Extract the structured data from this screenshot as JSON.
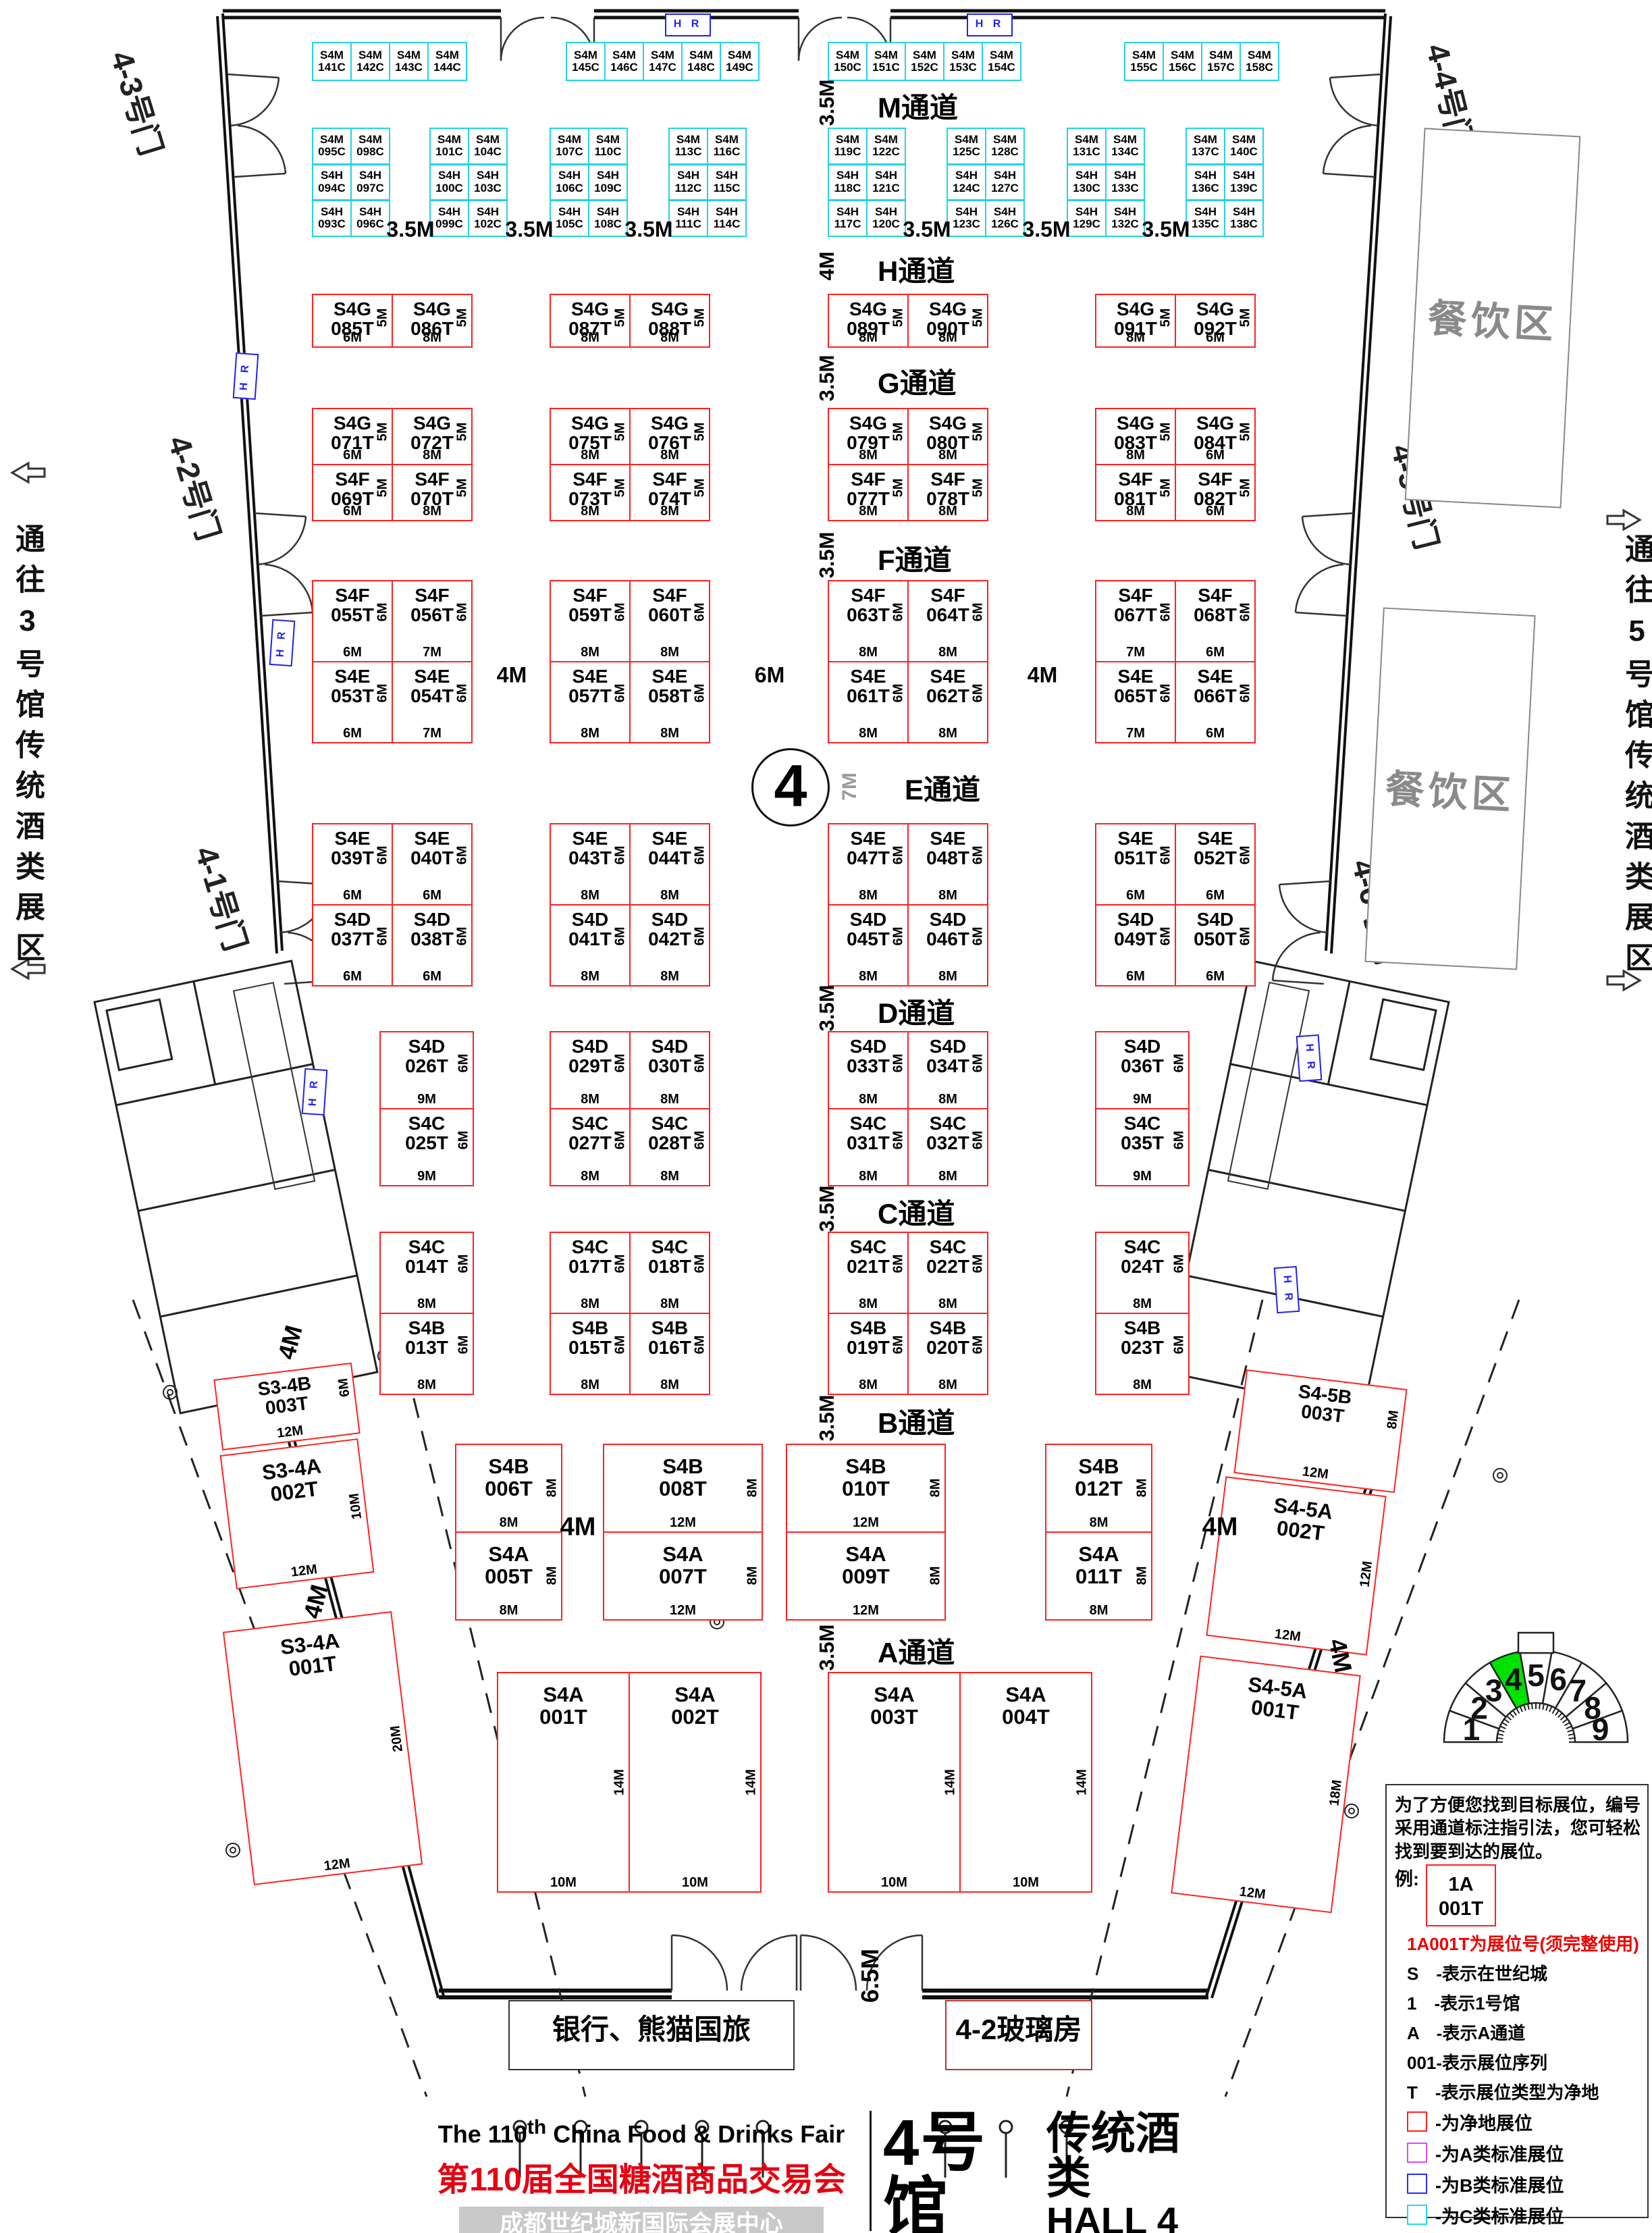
{
  "hall_circle": "4",
  "aisles": [
    {
      "dim": "3.5M",
      "name": "M通道"
    },
    {
      "dim": "4M",
      "name": "H通道"
    },
    {
      "dim": "3.5M",
      "name": "G通道"
    },
    {
      "dim": "3.5M",
      "name": "F通道"
    },
    {
      "dim": "7M",
      "name": "E通道"
    },
    {
      "dim": "3.5M",
      "name": "D通道"
    },
    {
      "dim": "3.5M",
      "name": "C通道"
    },
    {
      "dim": "3.5M",
      "name": "B通道"
    },
    {
      "dim": "3.5M",
      "name": "A通道"
    }
  ],
  "bottom_aisle_dim": "6.5M",
  "row2_gap_dim": "3.5M",
  "fe_gap_dims": [
    "4M",
    "6M",
    "4M"
  ],
  "ba_gap_dims": [
    "4M",
    "4M"
  ],
  "corner_gap_dims": [
    "4M",
    "4M",
    "4M"
  ],
  "top_c_groups": [
    [
      "S4M|141C",
      "S4M|142C",
      "S4M|143C",
      "S4M|144C"
    ],
    [
      "S4M|145C",
      "S4M|146C",
      "S4M|147C",
      "S4M|148C",
      "S4M|149C"
    ],
    [
      "S4M|150C",
      "S4M|151C",
      "S4M|152C",
      "S4M|153C",
      "S4M|154C"
    ],
    [
      "S4M|155C",
      "S4M|156C",
      "S4M|157C",
      "S4M|158C"
    ]
  ],
  "row2_groups": [
    [
      [
        "S4M|095C",
        "S4H|094C",
        "S4H|093C"
      ],
      [
        "S4M|098C",
        "S4H|097C",
        "S4H|096C"
      ]
    ],
    [
      [
        "S4M|101C",
        "S4H|100C",
        "S4H|099C"
      ],
      [
        "S4M|104C",
        "S4H|103C",
        "S4H|102C"
      ]
    ],
    [
      [
        "S4M|107C",
        "S4H|106C",
        "S4H|105C"
      ],
      [
        "S4M|110C",
        "S4H|109C",
        "S4H|108C"
      ]
    ],
    [
      [
        "S4M|113C",
        "S4H|112C",
        "S4H|111C"
      ],
      [
        "S4M|116C",
        "S4H|115C",
        "S4H|114C"
      ]
    ],
    [
      [
        "S4M|119C",
        "S4H|118C",
        "S4H|117C"
      ],
      [
        "S4M|122C",
        "S4H|121C",
        "S4H|120C"
      ]
    ],
    [
      [
        "S4M|125C",
        "S4H|124C",
        "S4H|123C"
      ],
      [
        "S4M|128C",
        "S4H|127C",
        "S4H|126C"
      ]
    ],
    [
      [
        "S4M|131C",
        "S4H|130C",
        "S4H|129C"
      ],
      [
        "S4M|134C",
        "S4H|133C",
        "S4H|132C"
      ]
    ],
    [
      [
        "S4M|137C",
        "S4H|136C",
        "S4H|135C"
      ],
      [
        "S4M|140C",
        "S4H|139C",
        "S4H|138C"
      ]
    ]
  ],
  "red_rows": [
    {
      "blocks": [
        {
          "top": [
            "S4G|085T|5M|6M",
            "S4G|086T|5M|8M"
          ]
        },
        {
          "top": [
            "S4G|087T|5M|8M",
            "S4G|088T|5M|8M"
          ]
        },
        {
          "top": [
            "S4G|089T|5M|8M",
            "S4G|090T|5M|8M"
          ]
        },
        {
          "top": [
            "S4G|091T|5M|8M",
            "S4G|092T|5M|6M"
          ]
        }
      ]
    },
    {
      "blocks": [
        {
          "top": [
            "S4G|071T|5M|6M",
            "S4G|072T|5M|8M"
          ],
          "bottom": [
            "S4F|069T|5M|6M",
            "S4F|070T|5M|8M"
          ]
        },
        {
          "top": [
            "S4G|075T|5M|8M",
            "S4G|076T|5M|8M"
          ],
          "bottom": [
            "S4F|073T|5M|8M",
            "S4F|074T|5M|8M"
          ]
        },
        {
          "top": [
            "S4G|079T|5M|8M",
            "S4G|080T|5M|8M"
          ],
          "bottom": [
            "S4F|077T|5M|8M",
            "S4F|078T|5M|8M"
          ]
        },
        {
          "top": [
            "S4G|083T|5M|8M",
            "S4G|084T|5M|6M"
          ],
          "bottom": [
            "S4F|081T|5M|8M",
            "S4F|082T|5M|6M"
          ]
        }
      ]
    },
    {
      "blocks": [
        {
          "top": [
            "S4F|055T|6M|6M",
            "S4F|056T|6M|7M"
          ],
          "bottom": [
            "S4E|053T|6M|6M",
            "S4E|054T|6M|7M"
          ]
        },
        {
          "top": [
            "S4F|059T|6M|8M",
            "S4F|060T|6M|8M"
          ],
          "bottom": [
            "S4E|057T|6M|8M",
            "S4E|058T|6M|8M"
          ]
        },
        {
          "top": [
            "S4F|063T|6M|8M",
            "S4F|064T|6M|8M"
          ],
          "bottom": [
            "S4E|061T|6M|8M",
            "S4E|062T|6M|8M"
          ]
        },
        {
          "top": [
            "S4F|067T|6M|7M",
            "S4F|068T|6M|6M"
          ],
          "bottom": [
            "S4E|065T|6M|7M",
            "S4E|066T|6M|6M"
          ]
        }
      ]
    },
    {
      "blocks": [
        {
          "top": [
            "S4E|039T|6M|6M",
            "S4E|040T|6M|6M"
          ],
          "bottom": [
            "S4D|037T|6M|6M",
            "S4D|038T|6M|6M"
          ]
        },
        {
          "top": [
            "S4E|043T|6M|8M",
            "S4E|044T|6M|8M"
          ],
          "bottom": [
            "S4D|041T|6M|8M",
            "S4D|042T|6M|8M"
          ]
        },
        {
          "top": [
            "S4E|047T|6M|8M",
            "S4E|048T|6M|8M"
          ],
          "bottom": [
            "S4D|045T|6M|8M",
            "S4D|046T|6M|8M"
          ]
        },
        {
          "top": [
            "S4E|051T|6M|6M",
            "S4E|052T|6M|6M"
          ],
          "bottom": [
            "S4D|049T|6M|6M",
            "S4D|050T|6M|6M"
          ]
        }
      ]
    },
    {
      "blocks": [
        {
          "top": [
            "S4D|026T|6M|9M"
          ],
          "bottom": [
            "S4C|025T|6M|9M"
          ]
        },
        {
          "top": [
            "S4D|029T|6M|8M",
            "S4D|030T|6M|8M"
          ],
          "bottom": [
            "S4C|027T|6M|8M",
            "S4C|028T|6M|8M"
          ]
        },
        {
          "top": [
            "S4D|033T|6M|8M",
            "S4D|034T|6M|8M"
          ],
          "bottom": [
            "S4C|031T|6M|8M",
            "S4C|032T|6M|8M"
          ]
        },
        {
          "top": [
            "S4D|036T|6M|9M"
          ],
          "bottom": [
            "S4C|035T|6M|9M"
          ]
        }
      ]
    },
    {
      "blocks": [
        {
          "top": [
            "S4C|014T|6M|8M"
          ],
          "bottom": [
            "S4B|013T|6M|8M"
          ]
        },
        {
          "top": [
            "S4C|017T|6M|8M",
            "S4C|018T|6M|8M"
          ],
          "bottom": [
            "S4B|015T|6M|8M",
            "S4B|016T|6M|8M"
          ]
        },
        {
          "top": [
            "S4C|021T|6M|8M",
            "S4C|022T|6M|8M"
          ],
          "bottom": [
            "S4B|019T|6M|8M",
            "S4B|020T|6M|8M"
          ]
        },
        {
          "top": [
            "S4C|024T|6M|8M"
          ],
          "bottom": [
            "S4B|023T|6M|8M"
          ]
        }
      ]
    },
    {
      "blocks": [
        {
          "top": [
            "S4B|006T|8M|8M"
          ],
          "bottom": [
            "S4A|005T|8M|8M"
          ]
        },
        {
          "top": [
            "S4B|008T|8M|12M"
          ],
          "bottom": [
            "S4A|007T|8M|12M"
          ]
        },
        {
          "top": [
            "S4B|010T|8M|12M"
          ],
          "bottom": [
            "S4A|009T|8M|12M"
          ]
        },
        {
          "top": [
            "S4B|012T|8M|8M"
          ],
          "bottom": [
            "S4A|011T|8M|8M"
          ]
        }
      ]
    },
    {
      "blocks": [
        {
          "top": [
            "S4A|001T|14M|10M",
            "S4A|002T|14M|10M"
          ]
        },
        {
          "top": [
            "S4A|003T|14M|10M",
            "S4A|004T|14M|10M"
          ]
        }
      ]
    }
  ],
  "corner_left": [
    "S3-4B|003T|6M|12M",
    "S3-4A|002T|10M|12M",
    "S3-4A|001T|20M|12M"
  ],
  "corner_right": [
    "S4-5B|003T|8M|12M",
    "S4-5A|002T|12M|12M",
    "S4-5A|001T|18M|12M"
  ],
  "doors": [
    "4-3号门",
    "4-2号门",
    "4-1号门",
    "4-4号门",
    "4-5号门",
    "4-6号门"
  ],
  "passage_left": "通往3号馆传统酒类展区",
  "passage_right": "通往5号馆传统酒类展区",
  "dining_label": "餐饮区",
  "bank_label": "银行、熊猫国旅",
  "glass_label": "4-2玻璃房",
  "hr_label": "H R",
  "legend": {
    "intro": "为了方便您找到目标展位，编号采用通道标注指引法，您可轻松找到要到达的展位。",
    "example_prefix": "例:",
    "sample_line1": "1A",
    "sample_line2": "001T",
    "note": "1A001T为展位号(须完整使用)",
    "defs": [
      "S　-表示在世纪城",
      "1　-表示1号馆",
      "A　-表示A通道",
      "001-表示展位序列",
      "T　-表示展位类型为净地"
    ],
    "swatches": [
      {
        "color": "#ff2222",
        "label": "-为净地展位"
      },
      {
        "color": "#d44dff",
        "label": "-为A类标准展位"
      },
      {
        "color": "#2a2aff",
        "label": "-为B类标准展位"
      },
      {
        "color": "#28d8e8",
        "label": "-为C类标准展位"
      },
      {
        "color": "#444444",
        "label": "-为D类标准展位"
      }
    ],
    "fire_note": "消防设施严禁遮挡"
  },
  "title": {
    "en": "The 110",
    "en_sup": "th",
    "en_rest": " China Food & Drinks Fair",
    "cn": "第110届全国糖酒商品交易会",
    "venue": "成都世纪城新国际会展中心",
    "hall_cn": "4号馆",
    "hall_type": "传统酒类",
    "hall_en": "HALL 4",
    "hall_type_en": "ALCOHOL",
    "map_label": "展位示意图"
  },
  "fan": {
    "halls": [
      "1",
      "2",
      "3",
      "4",
      "5",
      "6",
      "7",
      "8",
      "9"
    ],
    "active_index": 3,
    "active_color": "#00e100"
  }
}
